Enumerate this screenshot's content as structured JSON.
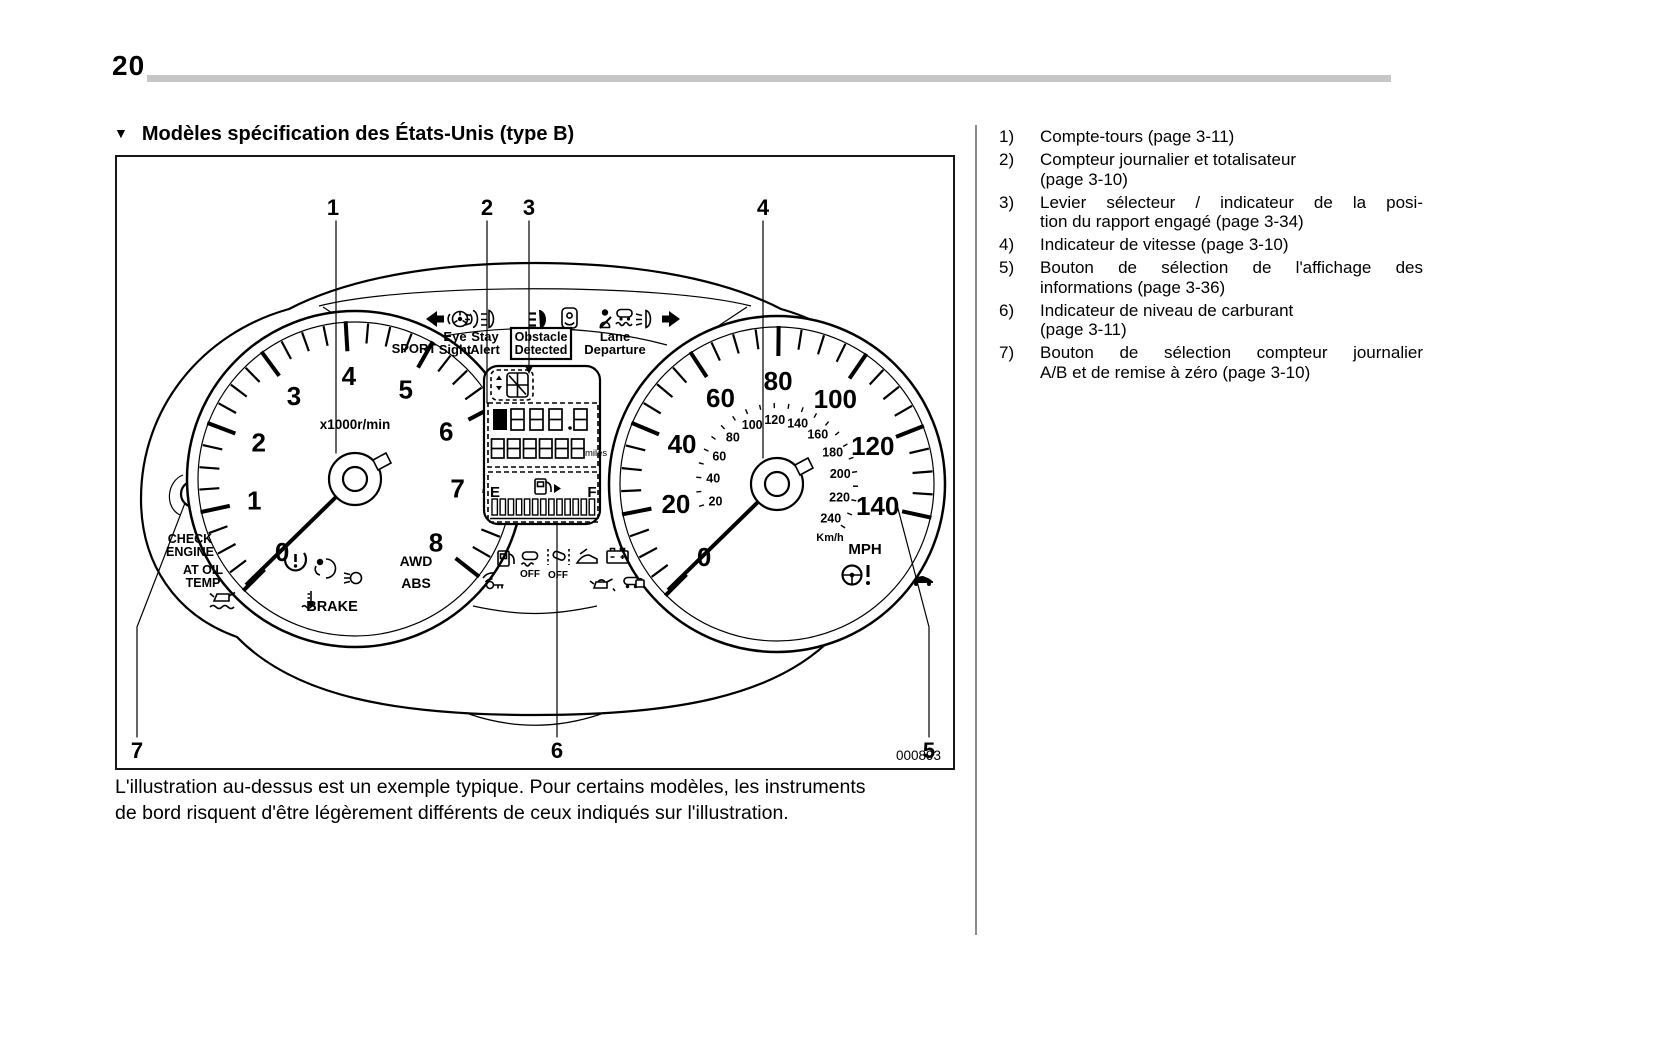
{
  "page_number": "20",
  "heading": {
    "marker": "▼",
    "text": "Modèles spécification des États-Unis (type B)"
  },
  "figure": {
    "code": "000893",
    "callouts": [
      "1",
      "2",
      "3",
      "4",
      "5",
      "6",
      "7"
    ],
    "cluster": {
      "top_row": {
        "sport": "SPORT",
        "eyesight_line1": "Eye",
        "eyesight_line2": "Sight",
        "stay_line1": "Stay",
        "stay_line2": "Alert",
        "obstacle_line1": "Obstacle",
        "obstacle_line2": "Detected",
        "lane_line1": "Lane",
        "lane_line2": "Departure"
      },
      "tachometer": {
        "numbers": [
          0,
          1,
          2,
          3,
          4,
          5,
          6,
          7,
          8
        ],
        "unit": "x1000r/min"
      },
      "speedometer": {
        "mph_numbers": [
          0,
          20,
          40,
          60,
          80,
          100,
          120,
          140
        ],
        "kmh_numbers": [
          20,
          40,
          60,
          80,
          100,
          120,
          140,
          160,
          180,
          200,
          220,
          240
        ],
        "mph_label": "MPH",
        "kmh_label": "Km/h"
      },
      "warning_labels": {
        "check_engine_line1": "CHECK",
        "check_engine_line2": "ENGINE",
        "at_oil_temp_line1": "AT OIL",
        "at_oil_temp_line2": "TEMP",
        "awd": "AWD",
        "abs": "ABS",
        "brake": "BRAKE",
        "off": "OFF"
      },
      "display": {
        "trip_a": "A",
        "trip_b": "B",
        "miles_label": "miles",
        "fuel_empty": "E",
        "fuel_full": "F"
      }
    }
  },
  "caption_lines": [
    "L'illustration au-dessus est un exemple typique. Pour certains modèles, les instruments",
    "de bord risquent d'être légèrement différents de ceux indiqués sur l'illustration."
  ],
  "legend": {
    "items": [
      {
        "num": "1)",
        "lines": [
          {
            "t": "Compte-tours (page 3-11)",
            "j": false
          }
        ]
      },
      {
        "num": "2)",
        "lines": [
          {
            "t": "Compteur journalier et totalisateur",
            "j": false
          },
          {
            "t": "(page 3-10)",
            "j": false
          }
        ]
      },
      {
        "num": "3)",
        "lines": [
          {
            "t": "Levier sélecteur / indicateur de la posi-",
            "j": true
          },
          {
            "t": "tion du rapport engagé (page 3-34)",
            "j": false
          }
        ]
      },
      {
        "num": "4)",
        "lines": [
          {
            "t": "Indicateur de vitesse (page 3-10)",
            "j": false
          }
        ]
      },
      {
        "num": "5)",
        "lines": [
          {
            "t": "Bouton de sélection de l'affichage des",
            "j": true
          },
          {
            "t": "informations (page 3-36)",
            "j": false
          }
        ]
      },
      {
        "num": "6)",
        "lines": [
          {
            "t": "Indicateur de niveau de carburant",
            "j": false
          },
          {
            "t": "(page 3-11)",
            "j": false
          }
        ]
      },
      {
        "num": "7)",
        "lines": [
          {
            "t": "Bouton de sélection compteur journalier",
            "j": true
          },
          {
            "t": "A/B et de remise à zéro (page 3-10)",
            "j": false
          }
        ]
      }
    ]
  }
}
